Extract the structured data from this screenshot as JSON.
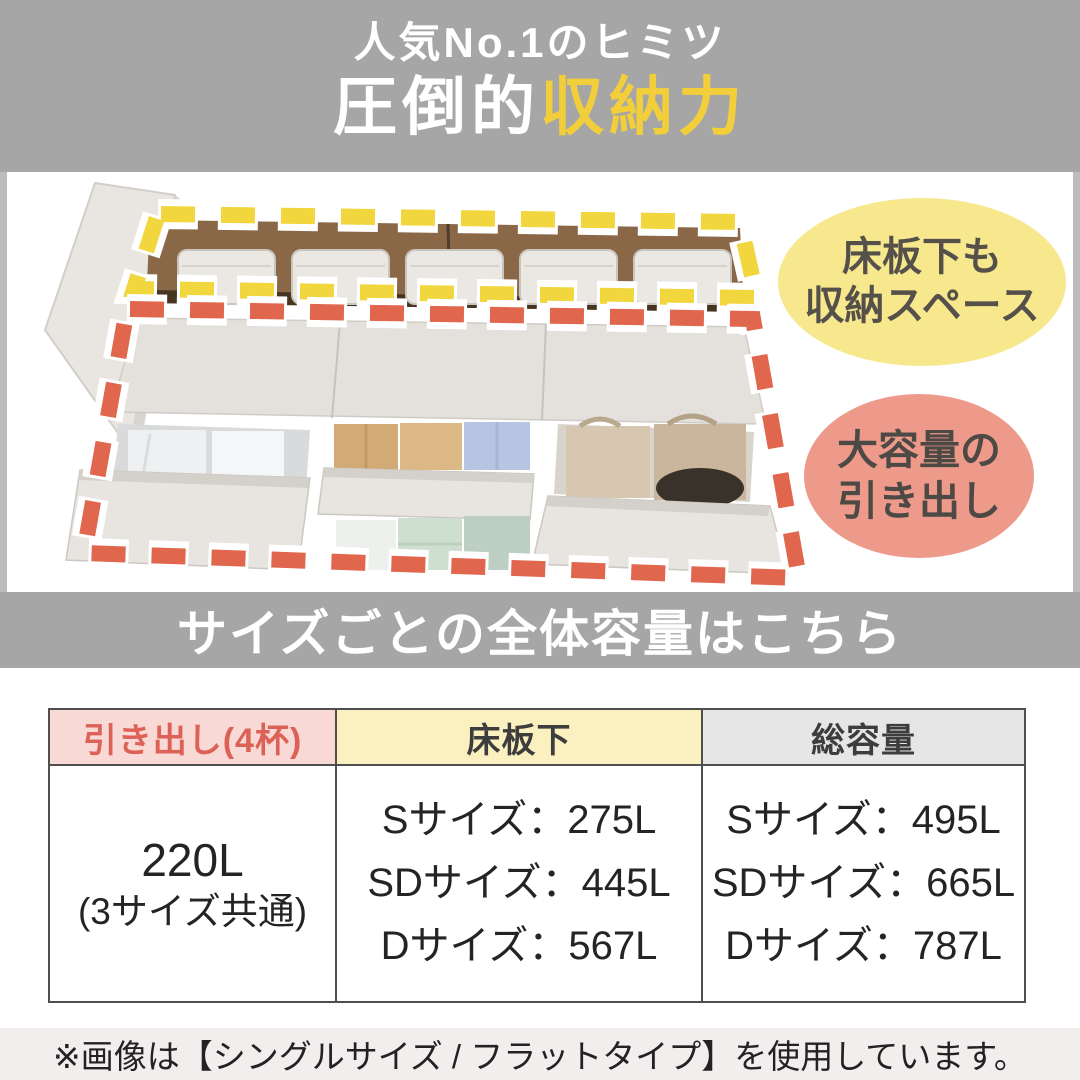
{
  "banner_top": {
    "subtitle": "人気No.1のヒミツ",
    "title_white": "圧倒的",
    "title_accent": "収納力"
  },
  "photo": {
    "bubble_underfloor": {
      "line1": "床板下も",
      "line2": "収納スペース"
    },
    "bubble_drawers": {
      "line1": "大容量の",
      "line2": "引き出し"
    }
  },
  "banner_mid": {
    "title": "サイズごとの全体容量はこちら"
  },
  "table": {
    "headers": {
      "drawers": "引き出し(4杯)",
      "underfloor": "床板下",
      "total": "総容量"
    },
    "row": {
      "drawers_value": "220L",
      "drawers_note": "(3サイズ共通)",
      "underfloor_lines": [
        "Sサイズ：275L",
        "SDサイズ：445L",
        "Dサイズ：567L"
      ],
      "total_lines": [
        "Sサイズ：495L",
        "SDサイズ：665L",
        "Dサイズ：787L"
      ]
    }
  },
  "footnote": {
    "text": "※画像は【シングルサイズ / フラットタイプ】を使用しています。"
  },
  "colors": {
    "banner_gray": "#a6a6a6",
    "title_accent_yellow": "#f2cf3a",
    "dash_yellow": "#f1d63e",
    "dash_red": "#e0664e",
    "bubble_yellow": "#f7e88d",
    "bubble_pink": "#ee9a8b",
    "header_pink_bg": "#f9d9d6",
    "header_pink_text": "#dc6156",
    "header_yellow_bg": "#fbf1c0",
    "header_gray_bg": "#e6e6e6",
    "note_bg": "#f2eeee"
  }
}
